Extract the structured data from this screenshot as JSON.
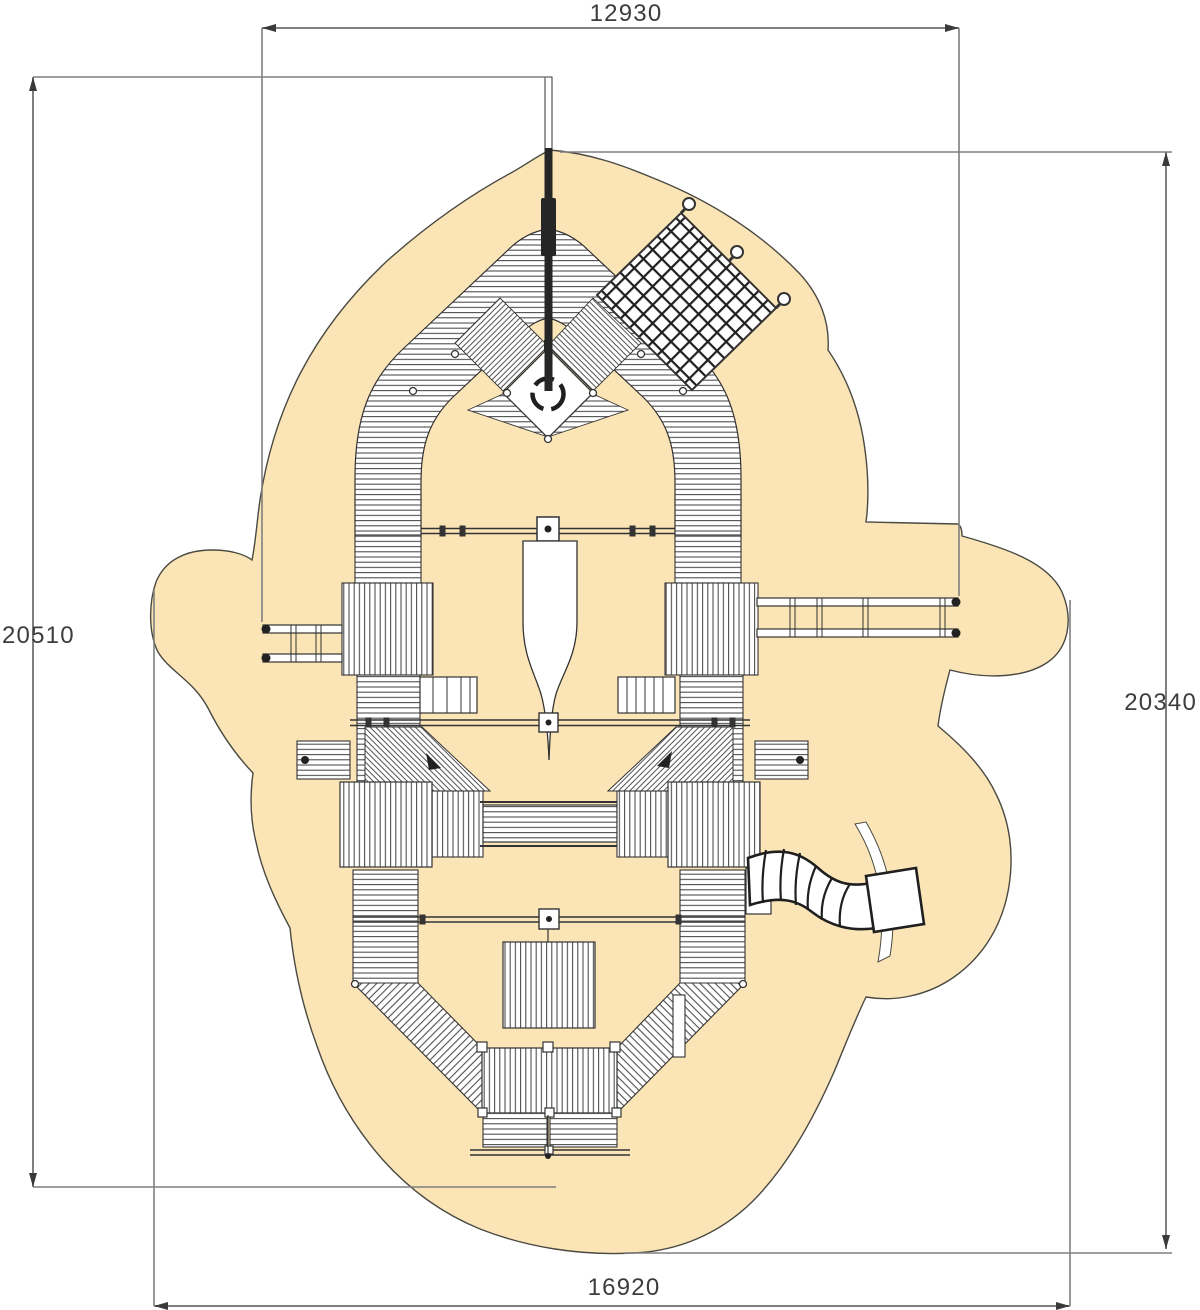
{
  "diagram": {
    "title": "playground-equipment-plan-view",
    "dimensions": {
      "top": "12930",
      "left": "20510",
      "right": "20340",
      "bottom": "16920"
    },
    "colors": {
      "surface": "#FBE5B6",
      "surface_outline": "#4A4A42",
      "linework": "#333333",
      "dimension_line": "#7F7F7F",
      "dimension_text": "#3D3D3D",
      "flag": "#262626",
      "background": "#FFFFFF"
    }
  }
}
